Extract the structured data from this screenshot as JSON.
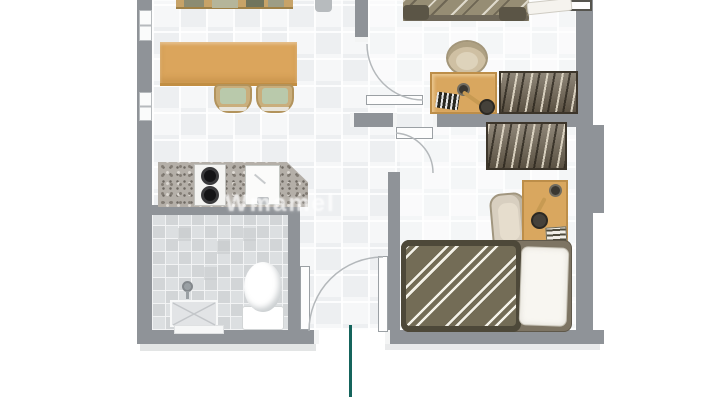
{
  "document": {
    "title": "Apartment unit floor plan (top-down rendering, top edge cropped)",
    "type": "floor-plan"
  },
  "watermark": {
    "text": "Wmamel"
  },
  "colors": {
    "background": "#ffffff",
    "wall": "#8f9398",
    "floor_tile": "#eff1f2",
    "bathroom_tile": "#d7d9db",
    "wood_furniture": "#d9a75f",
    "wardrobe": "#6f6452",
    "bed_mattress": "#736c56",
    "bed_frame": "#4d4839",
    "pillow": "#f8f6f1",
    "dining_chair_seat": "#b9c9ab",
    "counter_granite": "#b4afa8",
    "entrance_marker": "#15645c"
  },
  "rooms": [
    {
      "name": "living-dining",
      "furniture": [
        "kitchen-top-counter",
        "dining-table",
        "dining-chair-left",
        "dining-chair-right"
      ]
    },
    {
      "name": "kitchen",
      "furniture": [
        "granite-counter",
        "two-burner-stove",
        "sink"
      ]
    },
    {
      "name": "bathroom",
      "furniture": [
        "toilet",
        "shower-head",
        "shower-tray",
        "bath-mat"
      ]
    },
    {
      "name": "bedroom-1",
      "furniture": [
        "double-bed",
        "pillow",
        "round-chair",
        "desk",
        "desk-lamp",
        "keyboard",
        "wardrobe",
        "window"
      ]
    },
    {
      "name": "bedroom-2",
      "furniture": [
        "wardrobe",
        "lounge-chair",
        "desk",
        "desk-lamp",
        "notebook",
        "single-bed",
        "pillow"
      ]
    },
    {
      "name": "hallway-entry",
      "furniture": [
        "entry-door",
        "entrance-marker-line"
      ]
    }
  ],
  "doors": [
    "bedroom-1-door",
    "bedroom-2-door",
    "bathroom-door",
    "entry-door"
  ],
  "entrance": {
    "marker": "teal vertical line at main entrance"
  }
}
